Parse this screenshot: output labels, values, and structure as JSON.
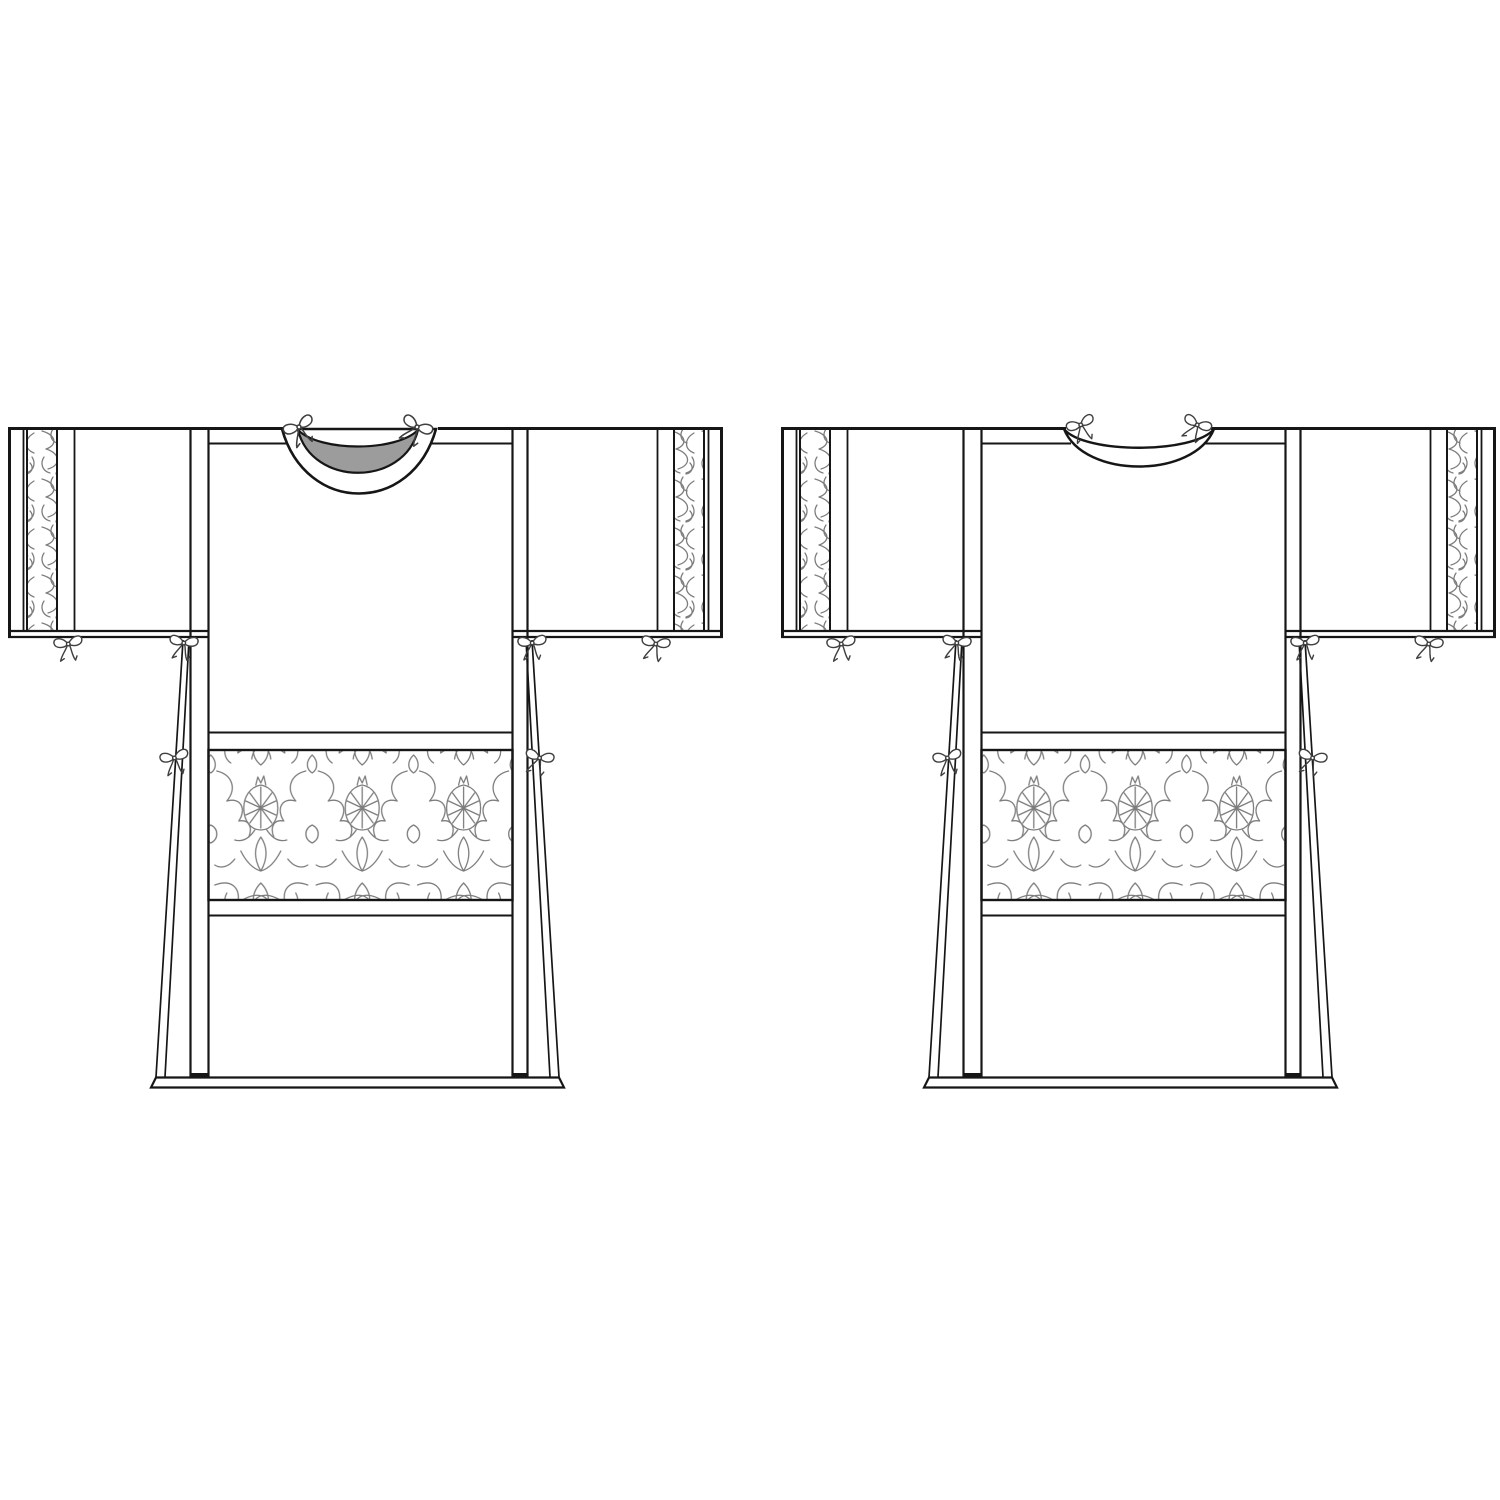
{
  "page": {
    "title": "Tunic pattern illustration, front and back views"
  },
  "colors": {
    "background": "#ffffff",
    "line": "#161616",
    "neck_opening_fill": "#9c9c9c",
    "damask_stroke": "#7d7d7d",
    "bow_stroke": "#3f3f3f"
  },
  "views": [
    {
      "name": "tunic-front",
      "description": "Front view: deep scooped neckline with shaded opening, ribbon ties at neck, cuffs, underarms and side gores, damask cuff bands and damask waist band"
    },
    {
      "name": "tunic-back",
      "description": "Back view: shallow curved neckband with ribbon ties, damask cuff bands and damask waist band"
    }
  ],
  "ornament": {
    "waist_band_style": "damask",
    "cuff_band_style": "damask",
    "tie_style": "ribbon-bow",
    "bow_ties_per_view": 8
  }
}
